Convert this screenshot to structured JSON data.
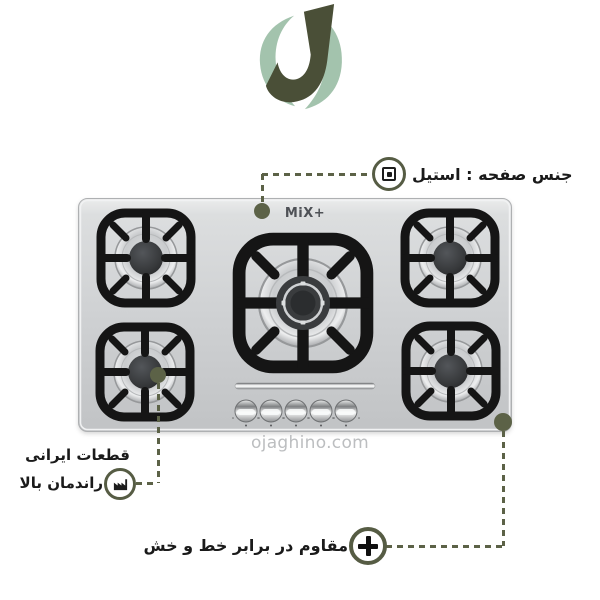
{
  "brand": {
    "logo_letter": "J",
    "cooktop_brand": "MiX+"
  },
  "watermark": "ojaghino.com",
  "annotations": {
    "surface": {
      "label": "جنس صفحه : استیل",
      "icon": "double-square-icon"
    },
    "parts": {
      "line1": "قطعات ایرانی",
      "line2": "راندمان بالا",
      "icon": "factory-icon"
    },
    "scratch": {
      "label": "مقاوم در برابر خط و خش",
      "icon": "plus-icon"
    }
  },
  "stove": {
    "brand": "MiX+",
    "burner_count": 5,
    "knob_count": 5
  },
  "colors": {
    "callout": "#5c6247",
    "logo_dark": "#4a4f37",
    "logo_light": "#a3c3ad",
    "text": "#1a1a1a",
    "watermark": "#bcbec0",
    "surface_steel": "#cdcfd1"
  }
}
